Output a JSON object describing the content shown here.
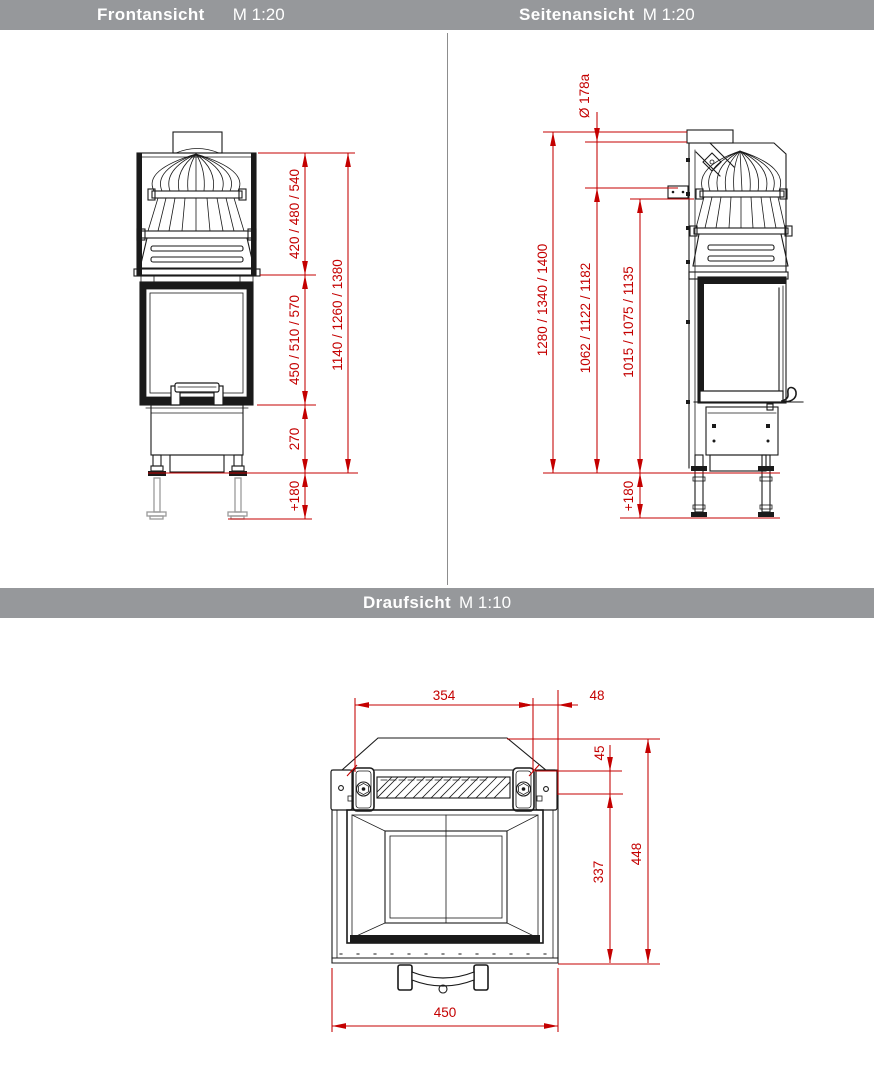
{
  "header": {
    "front": {
      "title": "Frontansicht",
      "scale": "M 1:20"
    },
    "side": {
      "title": "Seitenansicht",
      "scale": "M 1:20"
    },
    "top": {
      "title": "Draufsicht",
      "scale": "M 1:10"
    }
  },
  "colors": {
    "dimension_red": "#c40000",
    "drawing_black": "#1a1a1a",
    "header_bg": "#96989b",
    "header_text": "#ffffff",
    "leg_extension_gray": "#9a9a9a"
  },
  "front_view": {
    "dims": {
      "hood_height": "420 / 480 / 540",
      "firebox_height": "450 / 510 / 570",
      "plinth_height": "270",
      "leg_extension": "+180",
      "total_height": "1140 / 1260 / 1380"
    }
  },
  "side_view": {
    "dims": {
      "flue_diameter": "Ø 178a",
      "total_height": "1280 / 1340 / 1400",
      "flue_axis_height": "1062 / 1122 / 1182",
      "flue_base_height": "1015 / 1075 / 1135",
      "leg_extension": "+180"
    }
  },
  "top_view": {
    "dims": {
      "mounting_width": "354",
      "edge_offset": "48",
      "bracket_depth": "45",
      "body_depth": "337",
      "total_depth": "448",
      "total_width": "450"
    }
  }
}
